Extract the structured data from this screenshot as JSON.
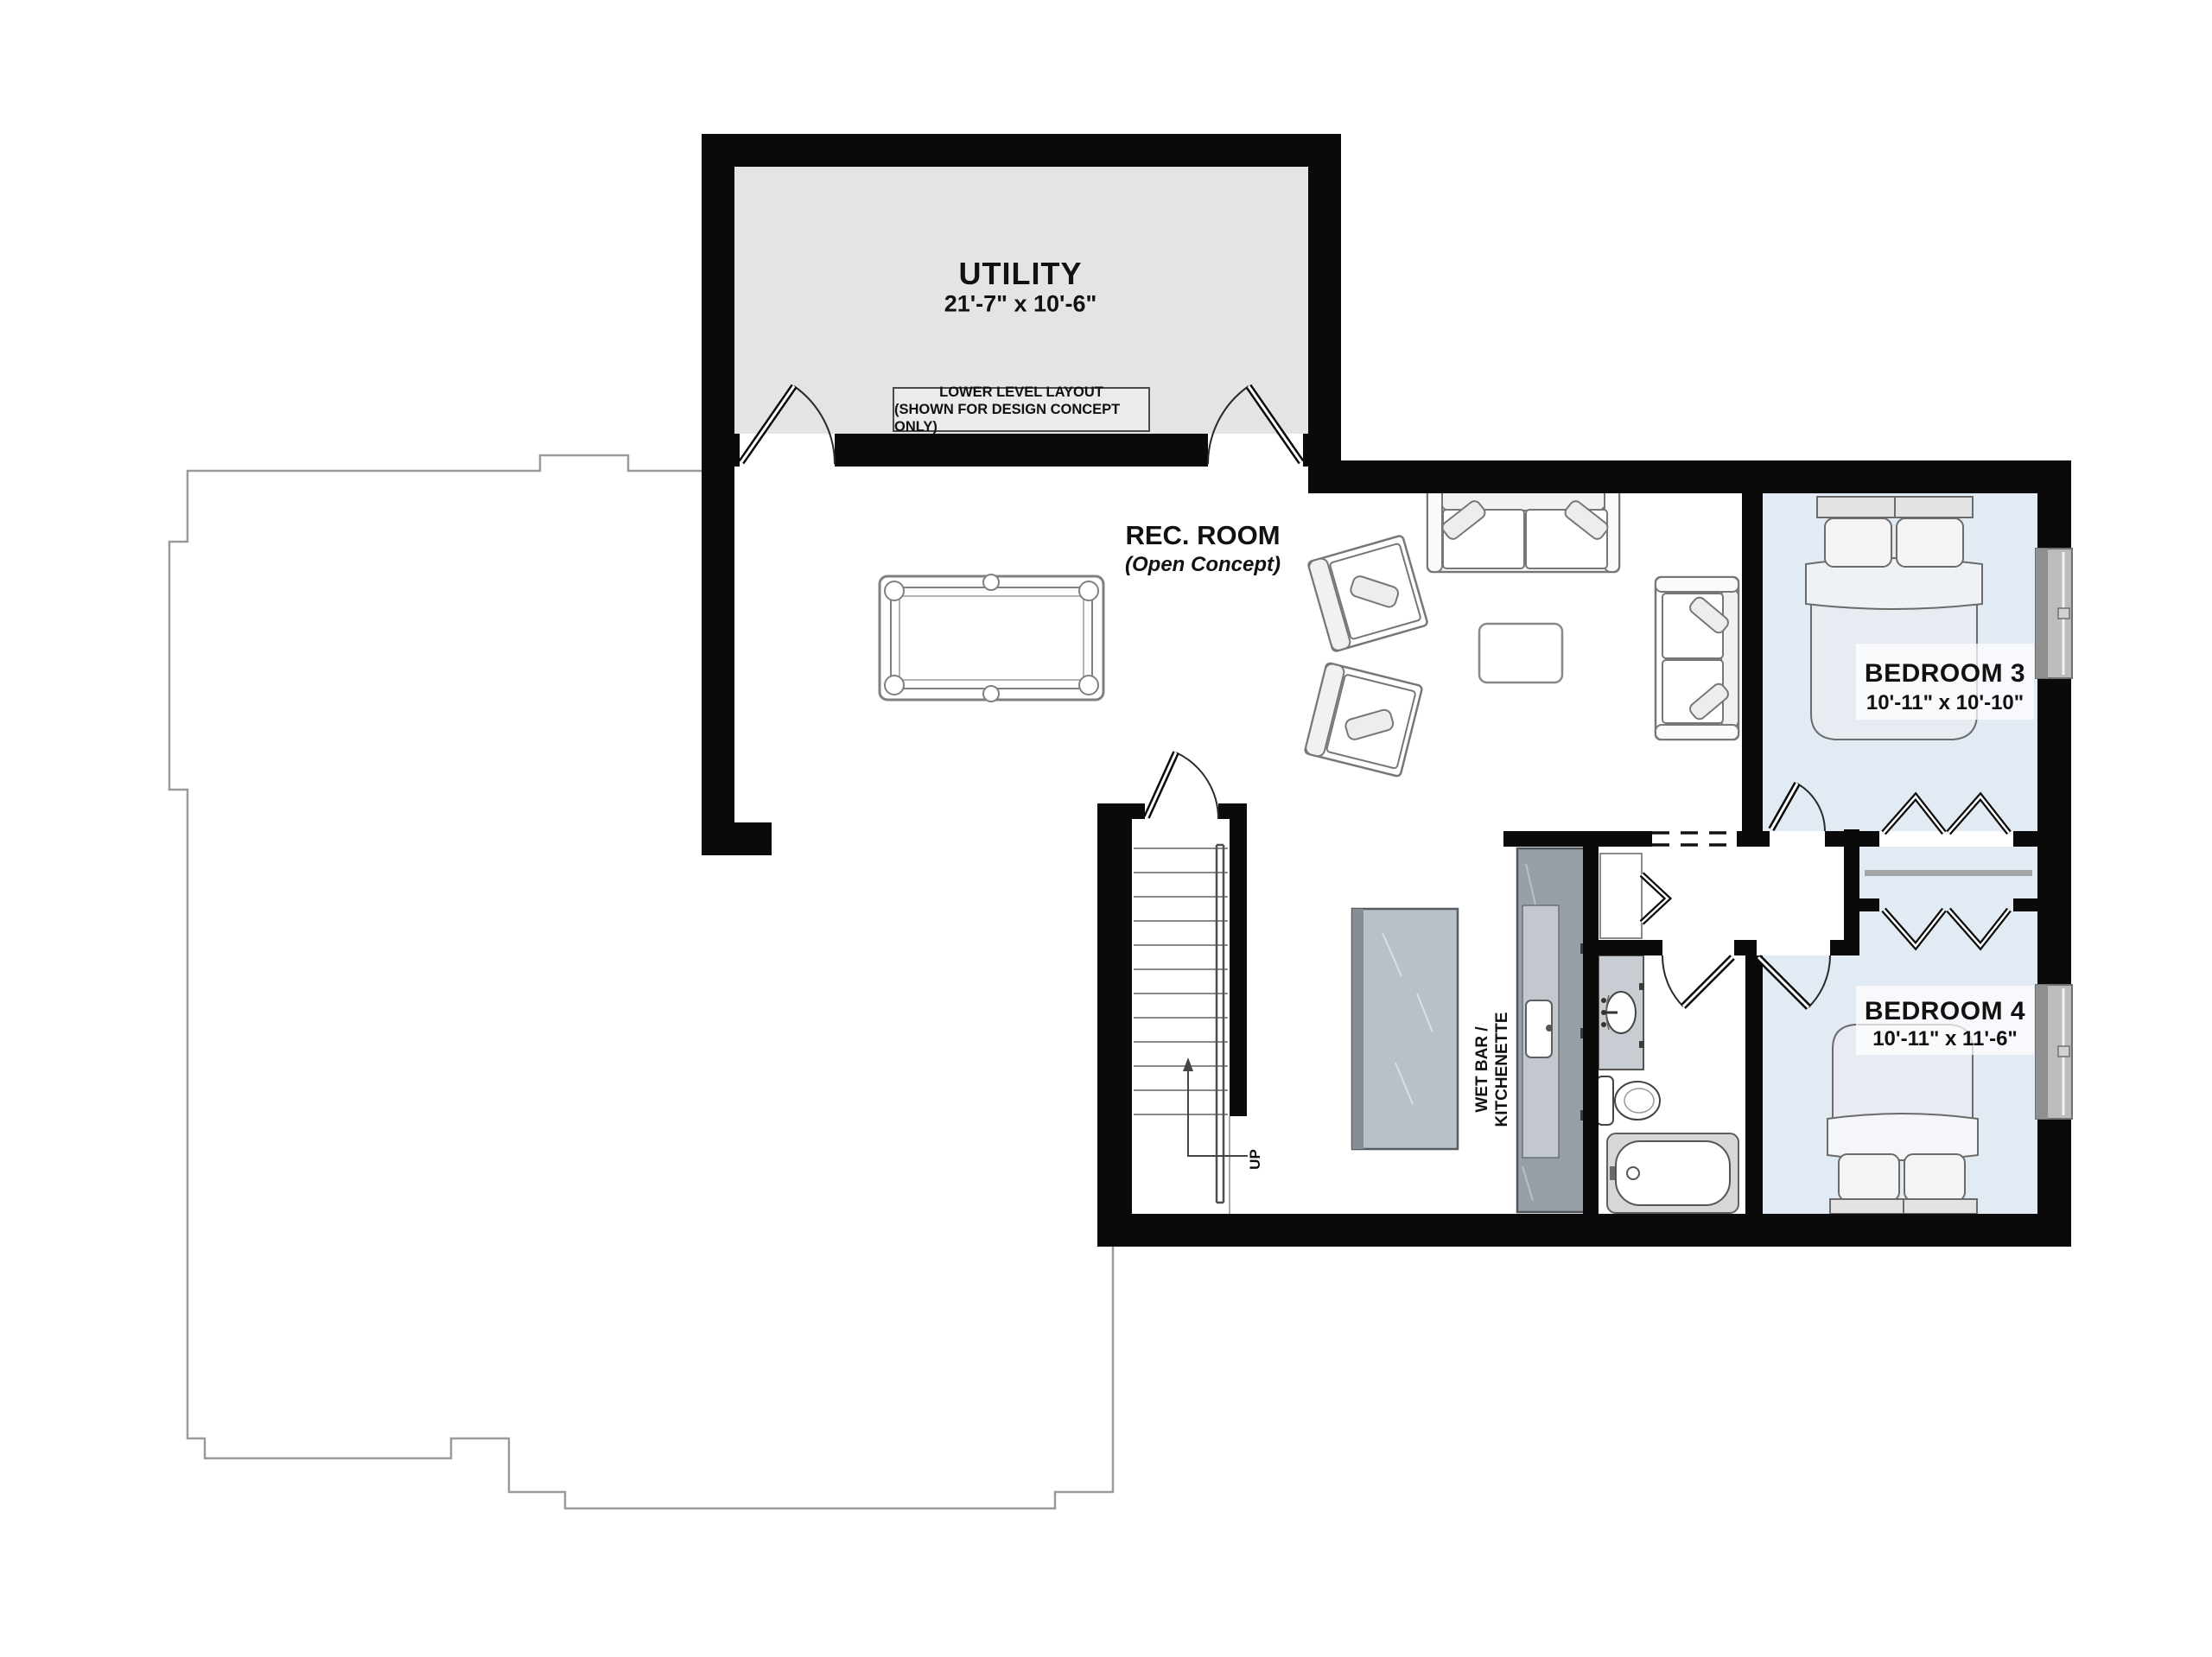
{
  "title": "Lower Level Floor Plan",
  "disclaimer": {
    "line1": "LOWER LEVEL LAYOUT",
    "line2": "(SHOWN FOR DESIGN CONCEPT ONLY)"
  },
  "rooms": {
    "utility": {
      "name": "UTILITY",
      "dims": "21'-7\" x 10'-6\""
    },
    "rec_room": {
      "name": "REC. ROOM",
      "sub": "(Open Concept)"
    },
    "bedroom3": {
      "name": "BEDROOM 3",
      "dims": "10'-11\" x 10'-10\""
    },
    "bedroom4": {
      "name": "BEDROOM 4",
      "dims": "10'-11\" x 11'-6\""
    },
    "wet_bar": {
      "line1": "WET BAR /",
      "line2": "KITCHENETTE"
    }
  },
  "stairs": {
    "direction_label": "UP"
  },
  "colors": {
    "wall": "#0a0a0a",
    "utility_floor": "#e4e4e4",
    "bedroom_floor": "#e2eaf3",
    "window_frame": "#8f8f8f",
    "window_glass": "#bcbcbc",
    "wet_bar_counter": "#98a0a7",
    "island": "#b9c0c7",
    "unfinished_outline": "#9a9a9a",
    "annotation": "#444444"
  }
}
